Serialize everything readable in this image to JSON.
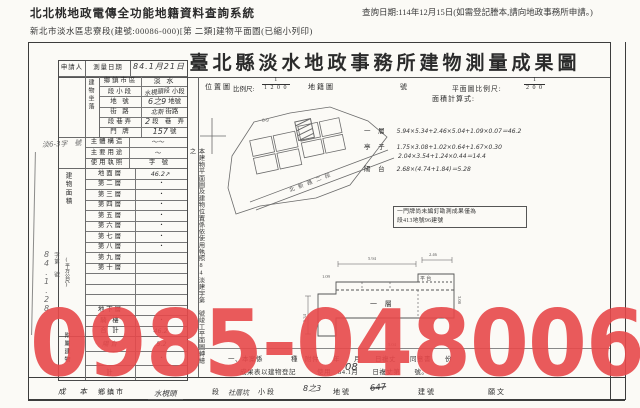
{
  "header": {
    "system_title": "北北桃地政電傳全功能地籍資料查詢系統",
    "doc_info": "新北市淡水區忠寮段(建號:00086-000)[第 二類]建物平面圖(已縮小列印)",
    "query_date": "查詢日期:114年12月15日(如需登記謄本,請向地政事務所申請。)"
  },
  "doc": {
    "title": "臺北縣淡水地政事務所建物測量成果圖",
    "applicant_label": "申請人",
    "survey_date_label": "測量日期",
    "survey_date_value": "84.1月21日",
    "location_label": "建物坐落",
    "location_rows": [
      {
        "label": "鄉鎮市區",
        "value": "淡 水",
        "hand": ""
      },
      {
        "label": "段小段",
        "value": "小段",
        "hand": "水梘頭段"
      },
      {
        "label": "地 號",
        "value": "地號",
        "hand": "6之9"
      },
      {
        "label": "街 路",
        "value": "街路",
        "hand": "北新"
      },
      {
        "label": "段巷弄",
        "value": "段　巷　弄",
        "hand": "2"
      },
      {
        "label": "門 牌",
        "value": "號",
        "hand": "157"
      }
    ],
    "mid_rows": [
      {
        "label": "主體構造",
        "value": "",
        "hand": "〜〜"
      },
      {
        "label": "主要用途",
        "value": "",
        "hand": "〜"
      },
      {
        "label": "使用執照",
        "value": "字　號",
        "hand": ""
      }
    ],
    "floor_label_v": "建物面積",
    "floor_unit_v": "(平方公尺)",
    "receipt_hand": "84.1.28",
    "receipt_label": "字第　號",
    "margin_stamp": "淡6-3字　號",
    "floor_rows": [
      {
        "label": "地面層",
        "value": "",
        "hand": "46.2↗"
      },
      {
        "label": "第二層",
        "value": "・",
        "hand": ""
      },
      {
        "label": "第三層",
        "value": "・",
        "hand": ""
      },
      {
        "label": "第四層",
        "value": "・",
        "hand": ""
      },
      {
        "label": "第五層",
        "value": "・",
        "hand": ""
      },
      {
        "label": "第六層",
        "value": "・",
        "hand": ""
      },
      {
        "label": "第七層",
        "value": "・",
        "hand": ""
      },
      {
        "label": "第八層",
        "value": "・",
        "hand": ""
      },
      {
        "label": "第九層",
        "value": "",
        "hand": ""
      },
      {
        "label": "第十層",
        "value": "",
        "hand": ""
      },
      {
        "label": "",
        "value": "",
        "hand": ""
      },
      {
        "label": "",
        "value": "",
        "hand": ""
      },
      {
        "label": "",
        "value": "",
        "hand": ""
      },
      {
        "label": "地下層",
        "value": "",
        "hand": ""
      },
      {
        "label": "騎 樓",
        "value": "・",
        "hand": ""
      },
      {
        "label": "合 計",
        "value": "",
        "hand": "46.2"
      }
    ],
    "annex_label_v": "附屬建物",
    "annex_rows": [
      {
        "label": "",
        "value": "",
        "hand_l": "陽台",
        "hand_v": "5.2"
      },
      {
        "label": "",
        "value": "・",
        "hand_l": "",
        "hand_v": ""
      },
      {
        "label": "計",
        "value": "",
        "hand_l": "",
        "hand_v": ""
      }
    ],
    "scale": {
      "map_title": "位置圖",
      "scale_label": "比例尺:",
      "map_num": "1",
      "map_den": "1 2 0 0",
      "cadastral_label": "地籍圖",
      "number_label": "號",
      "plan_scale_label": "平面圖比例尺:",
      "plan_num": "1",
      "plan_den": "2 0 0"
    },
    "calc": {
      "title": "面積計算式:",
      "lines": [
        {
          "pre": "一 層",
          "text": "5.94×5.34+2.46×5.04+1.09×0.07＝46.2"
        },
        {
          "pre": "亭 子",
          "text": "1.75×3.08+1.02×0.64+1.67×0.30"
        },
        {
          "pre": "",
          "text": "2.04×3.54+1.24×0.44＝14.4"
        },
        {
          "pre": "陽 台",
          "text": "2.68×(4.74+1.84)＝5.28"
        }
      ]
    },
    "vertical_note": "本建物平面圖及建物位置係依使用執照84淡建字第　號竣工平面圖轉繪之",
    "boxed_note": {
      "line1": "一門牌尚未編釘勘測成果僅為",
      "line2": "段413地號96建號"
    },
    "map": {
      "road_label": "北新路二段",
      "parcel_label": "6-9"
    },
    "plan": {
      "label": "一 層",
      "sublabel": "平 台",
      "dims": [
        "5.94",
        "2.46",
        "1.09",
        "5.34",
        "5.04",
        "3.08"
      ]
    },
    "remarks": {
      "line1": "一、本案係　　　　種　附件　　年　　月　　日複丈　　同意書　　份",
      "hand": "08",
      "line2": "成果表以建物登記　　　使用　84.1月　　日複丈第　　號。"
    },
    "footer": {
      "prefix": "成 本",
      "f_township": "鄉鎮市",
      "hand_township": "水梘頭",
      "f_section": "段",
      "hand_section": "社厝坑",
      "f_subsection": "小段",
      "hand_subsection": "8之3",
      "f_parcel": "地號",
      "hand_parcel": "647",
      "f_building": "建號",
      "f_last": "願文"
    }
  },
  "watermark": {
    "text": "0985-048006",
    "color": "#E8494B"
  }
}
